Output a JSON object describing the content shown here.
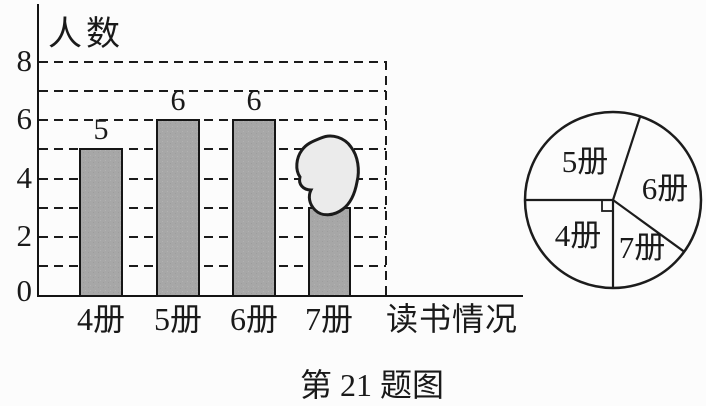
{
  "caption": "第 21 题图",
  "chart_data": [
    {
      "type": "bar",
      "title": "人数",
      "xlabel": "读书情况",
      "categories": [
        "4册",
        "5册",
        "6册",
        "7册"
      ],
      "values": [
        5,
        6,
        6,
        null
      ],
      "bar_value_labels": [
        "5",
        "6",
        "6"
      ],
      "obscured": {
        "category": "7册",
        "by": "ink-blot covering top of bar",
        "visible_height_reaches": 3
      },
      "ylim": [
        0,
        8
      ],
      "y_ticks_labeled": [
        0,
        2,
        4,
        6,
        8
      ],
      "y_tick_display": [
        "8",
        "6",
        "4",
        "2",
        "0"
      ],
      "gridlines_at": [
        1,
        2,
        3,
        4,
        5,
        6,
        7,
        8
      ],
      "grid_style": "dashed",
      "right_boundary": "vertical dashed line closing the grid on the right"
    },
    {
      "type": "pie",
      "slices": [
        {
          "label": "5册",
          "angle_deg": 108
        },
        {
          "label": "6册",
          "angle_deg": 108
        },
        {
          "label": "7册",
          "angle_deg": 54
        },
        {
          "label": "4册",
          "angle_deg": 90,
          "right_angle_marker": true
        }
      ],
      "annotations": [
        "small square at center marks the 4册 slice as a right angle (90°)"
      ]
    }
  ]
}
